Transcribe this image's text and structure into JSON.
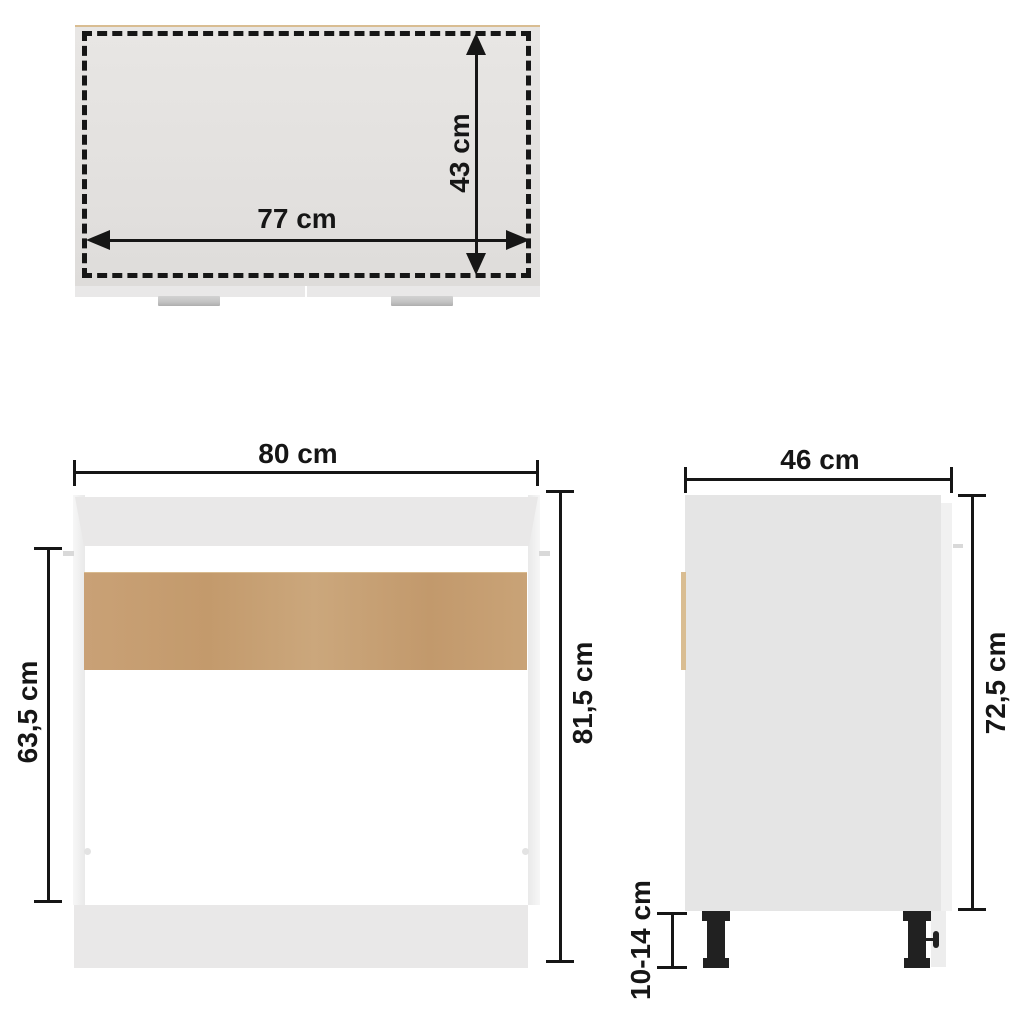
{
  "diagram": {
    "title": "sink bottom cabinet dimension drawing",
    "views": {
      "top": {
        "name": "top-view",
        "width_label": "77 cm",
        "depth_label": "43 cm"
      },
      "front": {
        "name": "front-view",
        "width_label": "80 cm",
        "height_label": "81,5 cm",
        "inner_height_label": "63,5 cm"
      },
      "side": {
        "name": "side-view",
        "depth_label": "46 cm",
        "height_label": "72,5 cm",
        "legs_label": "10-14 cm"
      }
    },
    "colors": {
      "dimension_ink": "#161616",
      "background": "#ffffff",
      "top_surface": "#e3e1df",
      "cabinet_gray": "#e9e8e8",
      "wood_panel": "#c7a074",
      "wood_edge": "#d9bd92",
      "handle_gray": "#c6c6c6",
      "leg_black": "#212121"
    }
  }
}
